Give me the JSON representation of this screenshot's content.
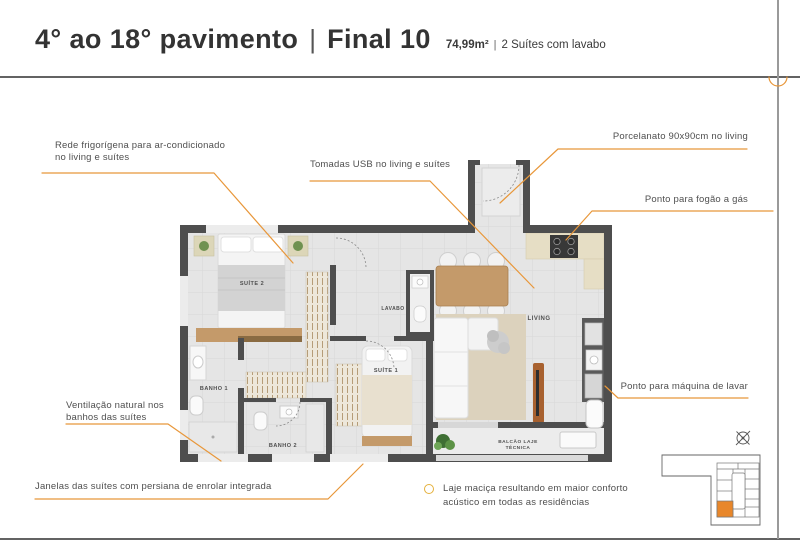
{
  "header": {
    "title": "4° ao 18° pavimento",
    "divider": "|",
    "unit": "Final 10",
    "area": "74,99m²",
    "area_divider": "|",
    "description": "2 Suítes com lavabo"
  },
  "annotations": {
    "rede_line1": "Rede frigorígena para ar-condicionado",
    "rede_line2": "no living e suítes",
    "tomadas": "Tomadas USB no living e suítes",
    "porcelanato": "Porcelanato 90x90cm no living",
    "fogao": "Ponto para fogão a gás",
    "maquina": "Ponto para máquina de lavar",
    "ventilacao_line1": "Ventilação natural nos",
    "ventilacao_line2": "banhos das suítes",
    "janelas": "Janelas das suítes com persiana de enrolar integrada",
    "laje_line1": "Laje maciça resultando em maior conforto",
    "laje_line2": "acústico em todas as residências"
  },
  "plan_labels": {
    "suite2": "SUÍTE 2",
    "suite1": "SUÍTE 1",
    "banho1": "BANHO 1",
    "banho2": "BANHO 2",
    "lavabo": "LAVABO",
    "living": "LIVING",
    "balcao_line1": "BALCÃO LAJE",
    "balcao_line2": "TÉCNICA"
  },
  "colors": {
    "accent_orange": "#E8973A",
    "keyplan_highlight": "#E8872B",
    "wall_gray": "#4E4E4E",
    "wood_tan": "#C49A6A"
  }
}
